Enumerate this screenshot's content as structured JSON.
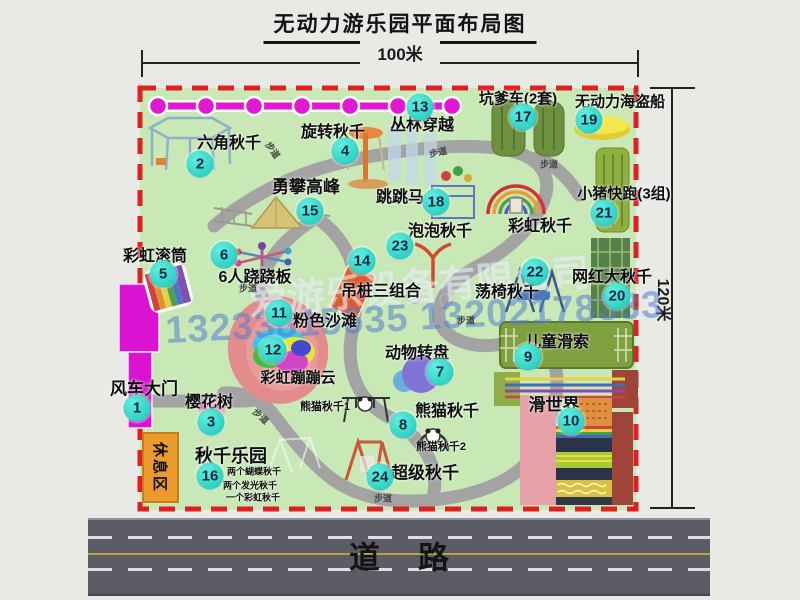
{
  "title": "无动力游乐园平面布局图",
  "dimension_top": "100米",
  "dimension_right": "120米",
  "road": {
    "label": "道路"
  },
  "rest_area": "休息区",
  "watermark": {
    "company": "爱游乐设备有限公司",
    "phone": "13233815635 13202178333"
  },
  "walkway_label": "步道",
  "walkways": [
    {
      "x": 273,
      "y": 150,
      "r": 55
    },
    {
      "x": 438,
      "y": 152,
      "r": -12
    },
    {
      "x": 549,
      "y": 164,
      "r": 0
    },
    {
      "x": 248,
      "y": 288,
      "r": 0
    },
    {
      "x": 466,
      "y": 320,
      "r": 0
    },
    {
      "x": 261,
      "y": 416,
      "r": 42
    },
    {
      "x": 383,
      "y": 498,
      "r": 0
    }
  ],
  "attractions": [
    {
      "num": "1",
      "name": "风车大门",
      "mx": 137,
      "my": 408,
      "lx": 144,
      "ly": 387,
      "fs": 17
    },
    {
      "num": "2",
      "name": "六角秋千",
      "mx": 200,
      "my": 164,
      "lx": 229,
      "ly": 141,
      "fs": 16
    },
    {
      "num": "3",
      "name": "樱花树",
      "mx": 211,
      "my": 422,
      "lx": 209,
      "ly": 400,
      "fs": 16
    },
    {
      "num": "4",
      "name": "旋转秋千",
      "mx": 345,
      "my": 151,
      "lx": 333,
      "ly": 130,
      "fs": 16
    },
    {
      "num": "5",
      "name": "彩虹滚筒",
      "mx": 163,
      "my": 274,
      "lx": 155,
      "ly": 254,
      "fs": 16
    },
    {
      "num": "6",
      "name": "6人跷跷板",
      "mx": 224,
      "my": 255,
      "lx": 255,
      "ly": 275,
      "fs": 16
    },
    {
      "num": "7",
      "name": "动物转盘",
      "mx": 440,
      "my": 372,
      "lx": 417,
      "ly": 351,
      "fs": 16
    },
    {
      "num": "8",
      "name": "熊猫秋千",
      "mx": 403,
      "my": 425,
      "lx": 447,
      "ly": 409,
      "fs": 16
    },
    {
      "num": "9",
      "name": "儿童滑索",
      "mx": 528,
      "my": 357,
      "lx": 557,
      "ly": 340,
      "fs": 16
    },
    {
      "num": "10",
      "name": "滑世界",
      "mx": 571,
      "my": 421,
      "lx": 554,
      "ly": 403,
      "fs": 17
    },
    {
      "num": "11",
      "name": "粉色沙滩",
      "mx": 279,
      "my": 313,
      "lx": 325,
      "ly": 319,
      "fs": 16
    },
    {
      "num": "12",
      "name": "彩虹蹦蹦云",
      "mx": 273,
      "my": 350,
      "lx": 298,
      "ly": 377,
      "fs": 15
    },
    {
      "num": "13",
      "name": "丛林穿越",
      "mx": 420,
      "my": 107,
      "lx": 422,
      "ly": 123,
      "fs": 16
    },
    {
      "num": "14",
      "name": "吊桩三组合",
      "mx": 362,
      "my": 261,
      "lx": 381,
      "ly": 289,
      "fs": 16
    },
    {
      "num": "15",
      "name": "勇攀高峰",
      "mx": 310,
      "my": 211,
      "lx": 306,
      "ly": 185,
      "fs": 17
    },
    {
      "num": "16",
      "name": "秋千乐园",
      "mx": 210,
      "my": 476,
      "lx": 231,
      "ly": 455,
      "fs": 18
    },
    {
      "num": "17",
      "name": "坑爹车(2套)",
      "mx": 523,
      "my": 117,
      "lx": 518,
      "ly": 98,
      "fs": 15
    },
    {
      "num": "18",
      "name": "跳跳马",
      "mx": 436,
      "my": 202,
      "lx": 400,
      "ly": 195,
      "fs": 16
    },
    {
      "num": "19",
      "name": "无动力海盗船",
      "mx": 589,
      "my": 120,
      "lx": 620,
      "ly": 101,
      "fs": 15
    },
    {
      "num": "20",
      "name": "网红大秋千",
      "mx": 617,
      "my": 296,
      "lx": 612,
      "ly": 275,
      "fs": 16
    },
    {
      "num": "21",
      "name": "小猪快跑(3组)",
      "mx": 604,
      "my": 213,
      "lx": 624,
      "ly": 193,
      "fs": 15
    },
    {
      "num": "22",
      "name": "荡椅秋千",
      "mx": 535,
      "my": 272,
      "lx": 507,
      "ly": 290,
      "fs": 16
    },
    {
      "num": "23",
      "name": "泡泡秋千",
      "mx": 400,
      "my": 246,
      "lx": 440,
      "ly": 229,
      "fs": 16
    },
    {
      "num": "24",
      "name": "超级秋千",
      "mx": 380,
      "my": 477,
      "lx": 425,
      "ly": 471,
      "fs": 17
    }
  ],
  "extra_labels": [
    {
      "text": "彩虹秋千",
      "x": 540,
      "y": 224,
      "fs": 16
    },
    {
      "text": "熊猫秋千1",
      "x": 325,
      "y": 406,
      "fs": 11
    },
    {
      "text": "熊猫秋千2",
      "x": 441,
      "y": 446,
      "fs": 11
    },
    {
      "text": "两个蝴蝶秋千",
      "x": 254,
      "y": 471,
      "fs": 9
    },
    {
      "text": "两个发光秋千",
      "x": 250,
      "y": 485,
      "fs": 9
    },
    {
      "text": "一个彩虹秋千",
      "x": 253,
      "y": 497,
      "fs": 9
    }
  ],
  "colors": {
    "marker": "#2ed2c4",
    "chain": "#e018d2",
    "border": "#e02020",
    "map_bg": "#c8e8b6",
    "path": "#a3a3a3",
    "road": "#5c5c64",
    "rest_area": "#ec9a2e",
    "gate": "#dc12d2"
  }
}
